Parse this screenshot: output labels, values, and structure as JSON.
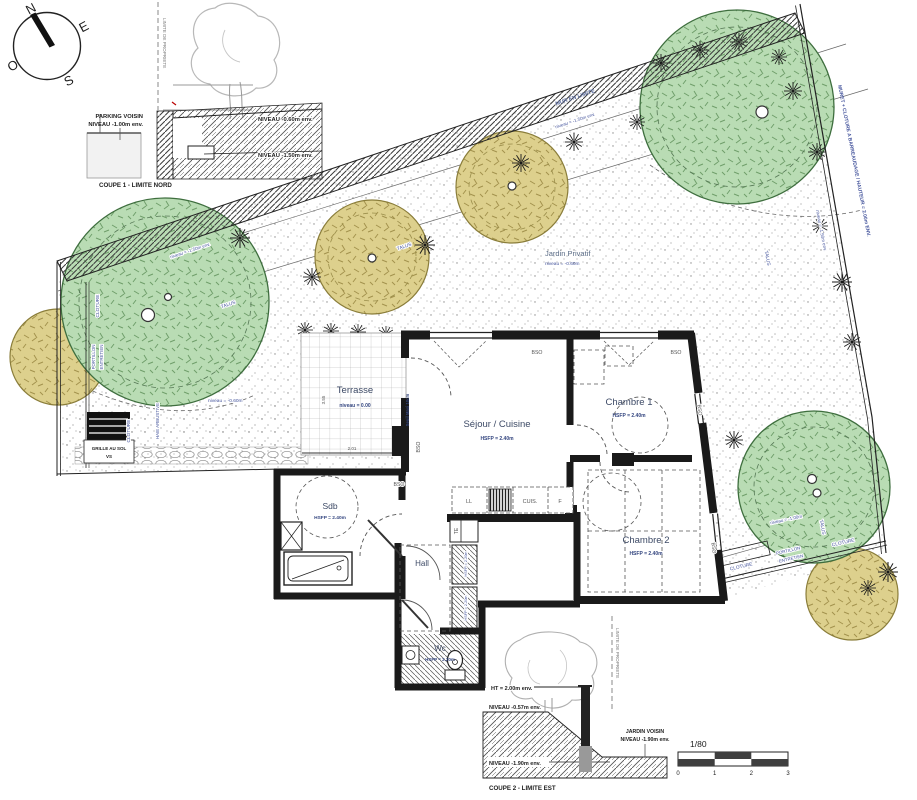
{
  "title": "Plan appartement rez-de-jardin 1/80",
  "compass": {
    "n": "N",
    "e": "E",
    "s": "S",
    "o": "O"
  },
  "coupe1": {
    "parking_line1": "PARKING VOISIN",
    "parking_line2": "NIVEAU -1.00m env.",
    "niveau_060": "NIVEAU -0.60m env.",
    "niveau_150": "NIVEAU -1.50m env.",
    "caption": "COUPE 1 - LIMITE NORD",
    "limite": "LIMITE DE PROPRIETE"
  },
  "garden": {
    "jardin_privatif": "Jardin Privatif",
    "jardin_privatif_niveau": "niveau = -0.60m",
    "mur_en_limite": "MUR EN LIMITE",
    "muret_cloture": "MURET + CLOTURE A BARREAUDAGE / HAUTEUR = 2.00m ENV.",
    "niveau_150": "niveau = -1.50m env.",
    "niveau_100": "niveau = -1.00m",
    "niveau_060": "niveau = -0.60m",
    "talus": "TALUS",
    "cloture": "CLOTURE",
    "portillon": "PORTILLON",
    "entretien": "ENTRETIEN",
    "grille_line1": "GRILLE AU SOL",
    "grille_line2": "VS",
    "haie": "HAIE ARBUSTIVE"
  },
  "building": {
    "rooms": {
      "terrasse": {
        "name": "Terrasse",
        "niveau": "niveau = 0.00"
      },
      "sejour": {
        "name": "Séjour / Cuisine",
        "hsfp": "HSFP = 2.40m"
      },
      "chambre1": {
        "name": "Chambre 1",
        "hsfp": "HSFP = 2.40m"
      },
      "chambre2": {
        "name": "Chambre 2",
        "hsfp": "HSFP = 2.40m"
      },
      "sdb": {
        "name": "Sdb",
        "hsfp": "HSFP = 2.40m"
      },
      "hall": {
        "name": "Hall"
      },
      "wc": {
        "name": "Wc",
        "hsfp": "HSFP = 2.20m"
      }
    },
    "kitchen": {
      "ll": "LL",
      "cuis": "CUIS.",
      "f": "F",
      "te": "TE",
      "duct_hsfp": "HSFP = 2.20m"
    },
    "annotations": {
      "bso": "BSO",
      "seuil": "Seuil Maxi 10cm",
      "dim_355": "3.55",
      "dim_201": "2.01"
    }
  },
  "coupe2": {
    "ht": "HT = 2.00m env.",
    "niveau_057": "NIVEAU -0.57m env.",
    "niveau_190": "NIVEAU -1.90m env.",
    "jardin_voisin_line1": "JARDIN VOISIN",
    "jardin_voisin_line2": "NIVEAU -1.90m env.",
    "caption": "COUPE 2 - LIMITE EST",
    "limite": "LIMITE DE PROPRIETE"
  },
  "scale_bar": {
    "ratio": "1/80",
    "t0": "0",
    "t1": "1",
    "t2": "2",
    "t3": "3"
  },
  "colors": {
    "tree_green": "#b9dcb4",
    "tree_green_edge": "#3e6e3e",
    "tree_yellow": "#ddd08d",
    "tree_yellow_edge": "#8a7d3a",
    "annotation_blue": "#44549c",
    "wall_black": "#1a1a1a"
  }
}
